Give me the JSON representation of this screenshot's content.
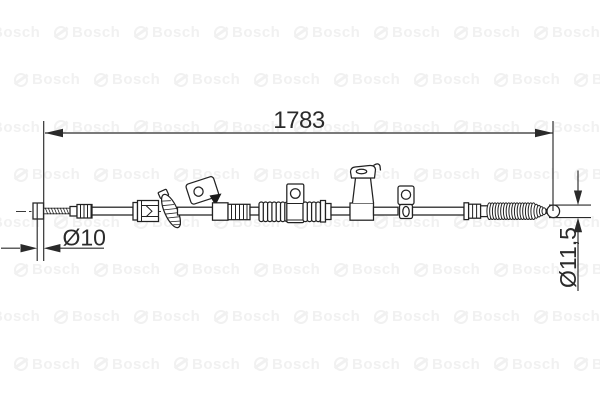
{
  "drawing": {
    "subject": "parking-brake-cable-technical-drawing",
    "dimensions": {
      "overall_length": {
        "label": "1783"
      },
      "left_end_diameter": {
        "label": "Ø10"
      },
      "right_end_diameter": {
        "label": "Ø11,5"
      }
    },
    "colors": {
      "background": "#ffffff",
      "line": "#222222",
      "dimension_text": "#2b2b2b",
      "watermark": "#f1f1f1"
    }
  },
  "watermark": {
    "text": "Bosch",
    "icon": "bosch-armature-icon"
  }
}
